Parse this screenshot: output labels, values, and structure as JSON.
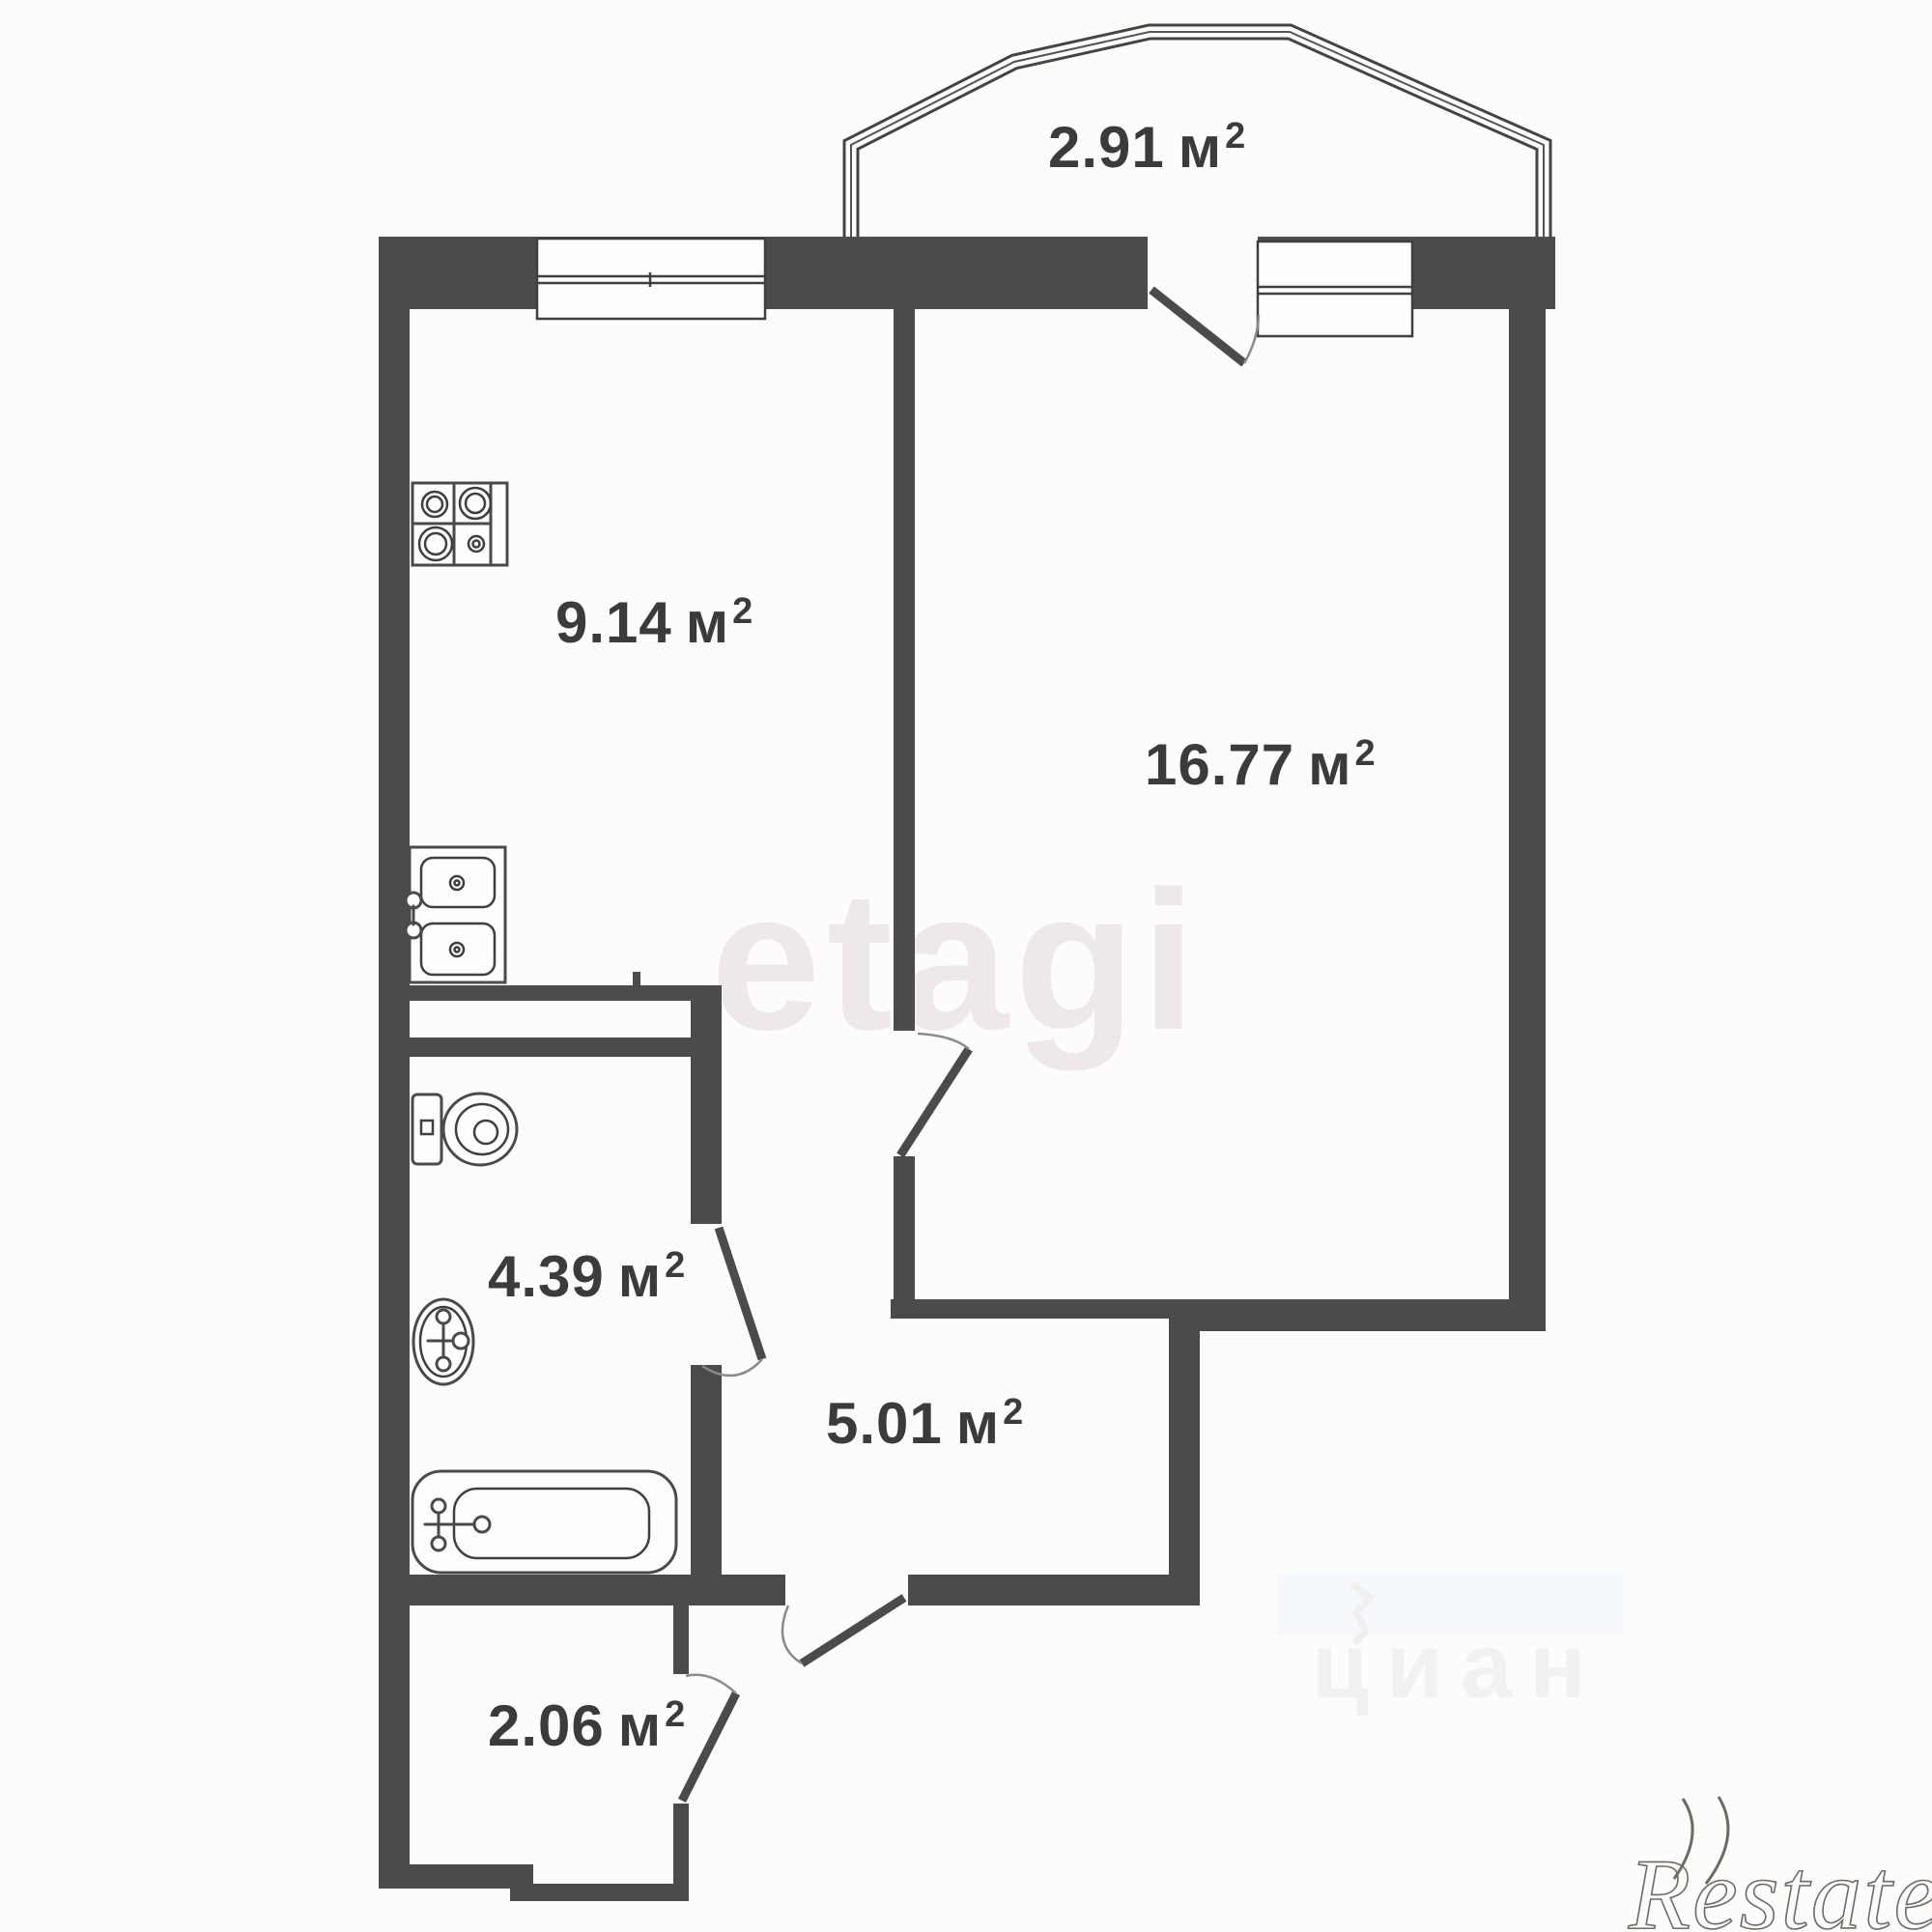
{
  "floor_plan": {
    "rooms": {
      "balcony": {
        "label": "2.91 м²",
        "value": "2.91",
        "unit": "м",
        "sup": "2"
      },
      "kitchen": {
        "label": "9.14 м²",
        "value": "9.14",
        "unit": "м",
        "sup": "2"
      },
      "living_room": {
        "label": "16.77 м²",
        "value": "16.77",
        "unit": "м",
        "sup": "2"
      },
      "bathroom": {
        "label": "4.39 м²",
        "value": "4.39",
        "unit": "м",
        "sup": "2"
      },
      "hallway": {
        "label": "5.01 м²",
        "value": "5.01",
        "unit": "м",
        "sup": "2"
      },
      "storage": {
        "label": "2.06 м²",
        "value": "2.06",
        "unit": "м",
        "sup": "2"
      }
    },
    "fixtures": {
      "icons": [
        "stove-icon",
        "kitchen-sink-icon",
        "toilet-icon",
        "washbasin-icon",
        "bathtub-icon"
      ]
    },
    "watermarks": {
      "center": "etagi",
      "portal": "циан",
      "agency": "Restate",
      "agency_marks": "))"
    },
    "colors": {
      "wall": "#4b4b49",
      "line": "#3f3f3d",
      "arc": "#8b8b89",
      "background": "#fcfcfb",
      "label_text": "#3b3b39",
      "watermark_center": "#efe8e8",
      "watermark_portal": "#f1f1ef",
      "watermark_blue_patch": "#f5f9fc",
      "watermark_agency": "#6f6a63"
    }
  }
}
